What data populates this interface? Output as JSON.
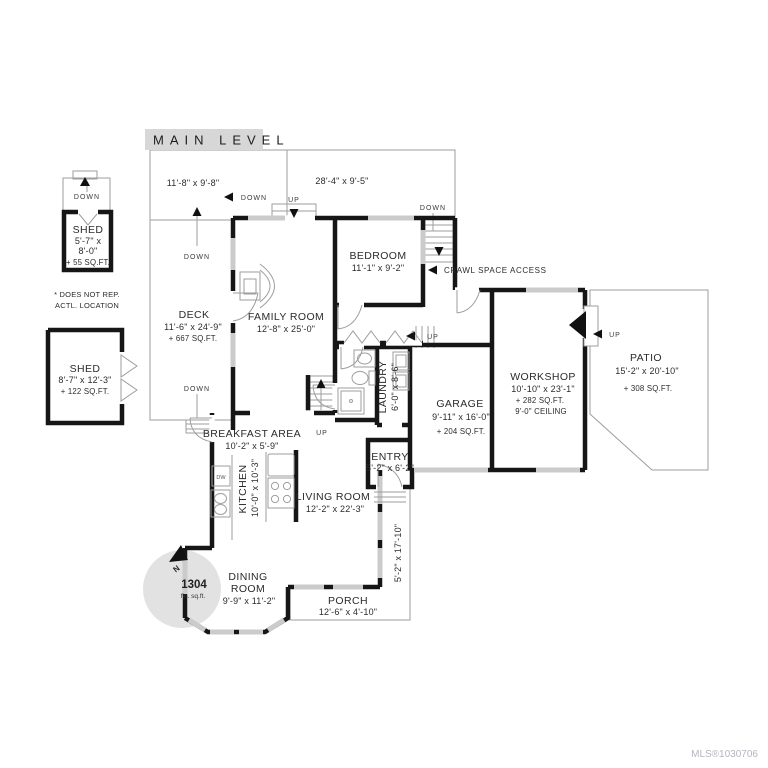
{
  "title": "MAIN LEVEL",
  "watermark": "MLS®1030706",
  "labels": {
    "up": "UP",
    "down": "DOWN",
    "crawl": "CRAWL SPACE ACCESS",
    "dw": "DW"
  },
  "compass": {
    "north": "N",
    "sqft": "1304",
    "sqft_label": "fin. sq.ft."
  },
  "colors": {
    "wall": "#161616",
    "window": "#cbcbcb",
    "thin_line": "#9e9e9e",
    "title_box": "#d7d7d7",
    "compass_fill": "#e2e2e2",
    "watermark": "#b2b6be"
  },
  "outbuildings": {
    "shed1": {
      "name": "SHED",
      "dim1": "5'-7\" x",
      "dim2": "8'-0\"",
      "area": "+ 55 SQ.FT.",
      "note1": "* DOES NOT REP.",
      "note2": "ACTL. LOCATION"
    },
    "shed2": {
      "name": "SHED",
      "dims": "8'-7\" x 12'-3\"",
      "area": "+ 122 SQ.FT."
    }
  },
  "areas": {
    "upper_deck_left": {
      "dims": "11'-8\" x 9'-8\""
    },
    "upper_deck_top": {
      "dims": "28'-4\" x 9'-5\""
    },
    "deck": {
      "name": "DECK",
      "dims": "11'-6\" x 24'-9\"",
      "area": "+ 667 SQ.FT."
    },
    "family_room": {
      "name": "FAMILY ROOM",
      "dims": "12'-8\" x 25'-0\""
    },
    "bedroom": {
      "name": "BEDROOM",
      "dims": "11'-1\" x 9'-2\""
    },
    "laundry": {
      "name": "LAUNDRY",
      "dims": "6'-0\" x 8'-6\""
    },
    "garage": {
      "name": "GARAGE",
      "dims": "9'-11\" x 16'-0\"",
      "area": "+ 204 SQ.FT."
    },
    "workshop": {
      "name": "WORKSHOP",
      "dims": "10'-10\" x 23'-1\"",
      "area": "+ 282 SQ.FT.",
      "ceiling": "9'-0\" CEILING"
    },
    "patio": {
      "name": "PATIO",
      "dims": "15'-2\" x 20'-10\"",
      "area": "+ 308 SQ.FT."
    },
    "entry": {
      "name": "ENTRY",
      "dims": "5'-2\" x 6'-2\""
    },
    "breakfast": {
      "name": "BREAKFAST AREA",
      "dims": "10'-2\" x 5'-9\""
    },
    "kitchen": {
      "name": "KITCHEN",
      "dims": "10'-0\" x 10'-3\""
    },
    "living_room": {
      "name": "LIVING ROOM",
      "dims": "12'-2\" x 22'-3\""
    },
    "dining_room": {
      "name1": "DINING",
      "name2": "ROOM",
      "dims": "9'-9\" x 11'-2\""
    },
    "porch": {
      "name": "PORCH",
      "dims": "12'-6\" x 4'-10\""
    },
    "side_porch": {
      "dims": "5'-2\" x 17'-10\""
    }
  }
}
